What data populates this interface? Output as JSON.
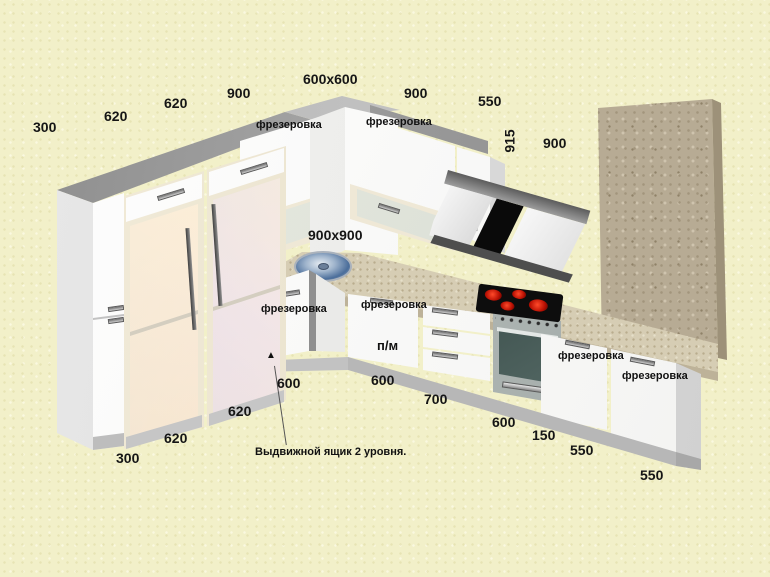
{
  "scene": {
    "description": "3D kitchen cabinetry render with dimension callouts",
    "language": "ru"
  },
  "dimensions": {
    "top": {
      "end_left": "300",
      "tall1": "620",
      "tall2": "620",
      "wall_left": "900",
      "corner": "600x600",
      "wall_right": "900",
      "wall_end": "550"
    },
    "hood": {
      "height": "915",
      "width": "900"
    },
    "corner_worktop": "900x900",
    "bottom": {
      "end_left": "300",
      "fridge1": "620",
      "fridge2": "620",
      "corner_left": "600",
      "corner_right": "600",
      "drawers": "700",
      "oven": "600",
      "filler": "150",
      "door1": "550",
      "door2": "550"
    }
  },
  "unit_labels": {
    "milling": "фрезеровка",
    "dishwasher": "п/м"
  },
  "annotation": {
    "marker": "▲",
    "text": "Выдвижной ящик 2 уровня."
  },
  "colors": {
    "background": "#f2f0c9",
    "cabinet_front": "#fbfbfb",
    "cabinet_top": "#9e9e9e",
    "countertop": "#d6cdb4",
    "stone_panel": "#b7ab94",
    "hood_glass": "#0a0a0a",
    "burner": "#cc1405",
    "sink": "#5a7fae",
    "text": "#151515"
  }
}
